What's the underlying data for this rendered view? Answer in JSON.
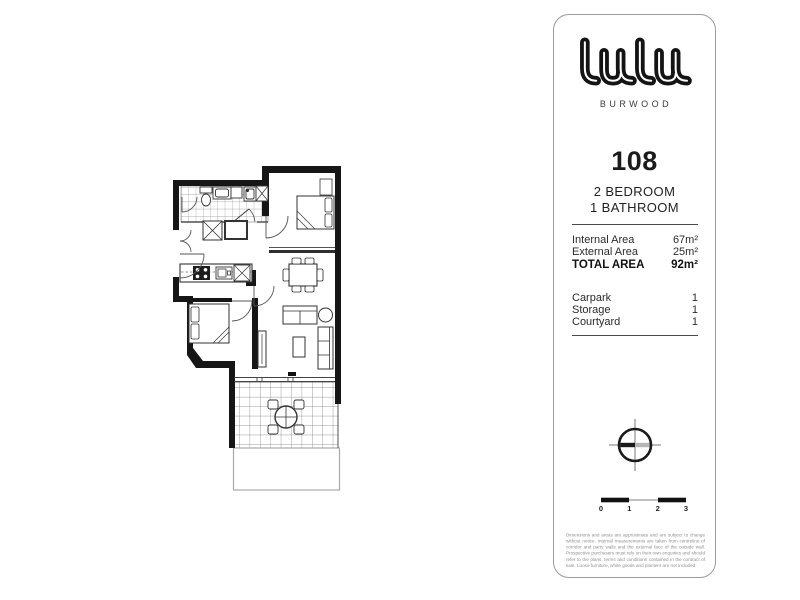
{
  "panel": {
    "logo": {
      "brand": "lulu",
      "location": "BURWOOD"
    },
    "unit": {
      "number": "108",
      "bedrooms": "2 BEDROOM",
      "bathrooms": "1 BATHROOM"
    },
    "areas": {
      "internal": {
        "label": "Internal Area",
        "value": "67m²"
      },
      "external": {
        "label": "External Area",
        "value": "25m²"
      },
      "total": {
        "label": "TOTAL AREA",
        "value": "92m²"
      }
    },
    "inclusions": [
      {
        "label": "Carpark",
        "value": "1"
      },
      {
        "label": "Storage",
        "value": "1"
      },
      {
        "label": "Courtyard",
        "value": "1"
      }
    ],
    "scalebar": {
      "labels": [
        "0",
        "1",
        "2",
        "3"
      ]
    },
    "disclaimer": "Dimensions and areas are approximate and are subject to change without notice. Internal measurements are taken from centreline of corridor and party walls and the external face of the outside wall. Prospective purchasers must rely on their own enquiries and should refer to the plans, terms and conditions contained in the contract of sale. Loose furniture, white goods and planters are not included."
  }
}
